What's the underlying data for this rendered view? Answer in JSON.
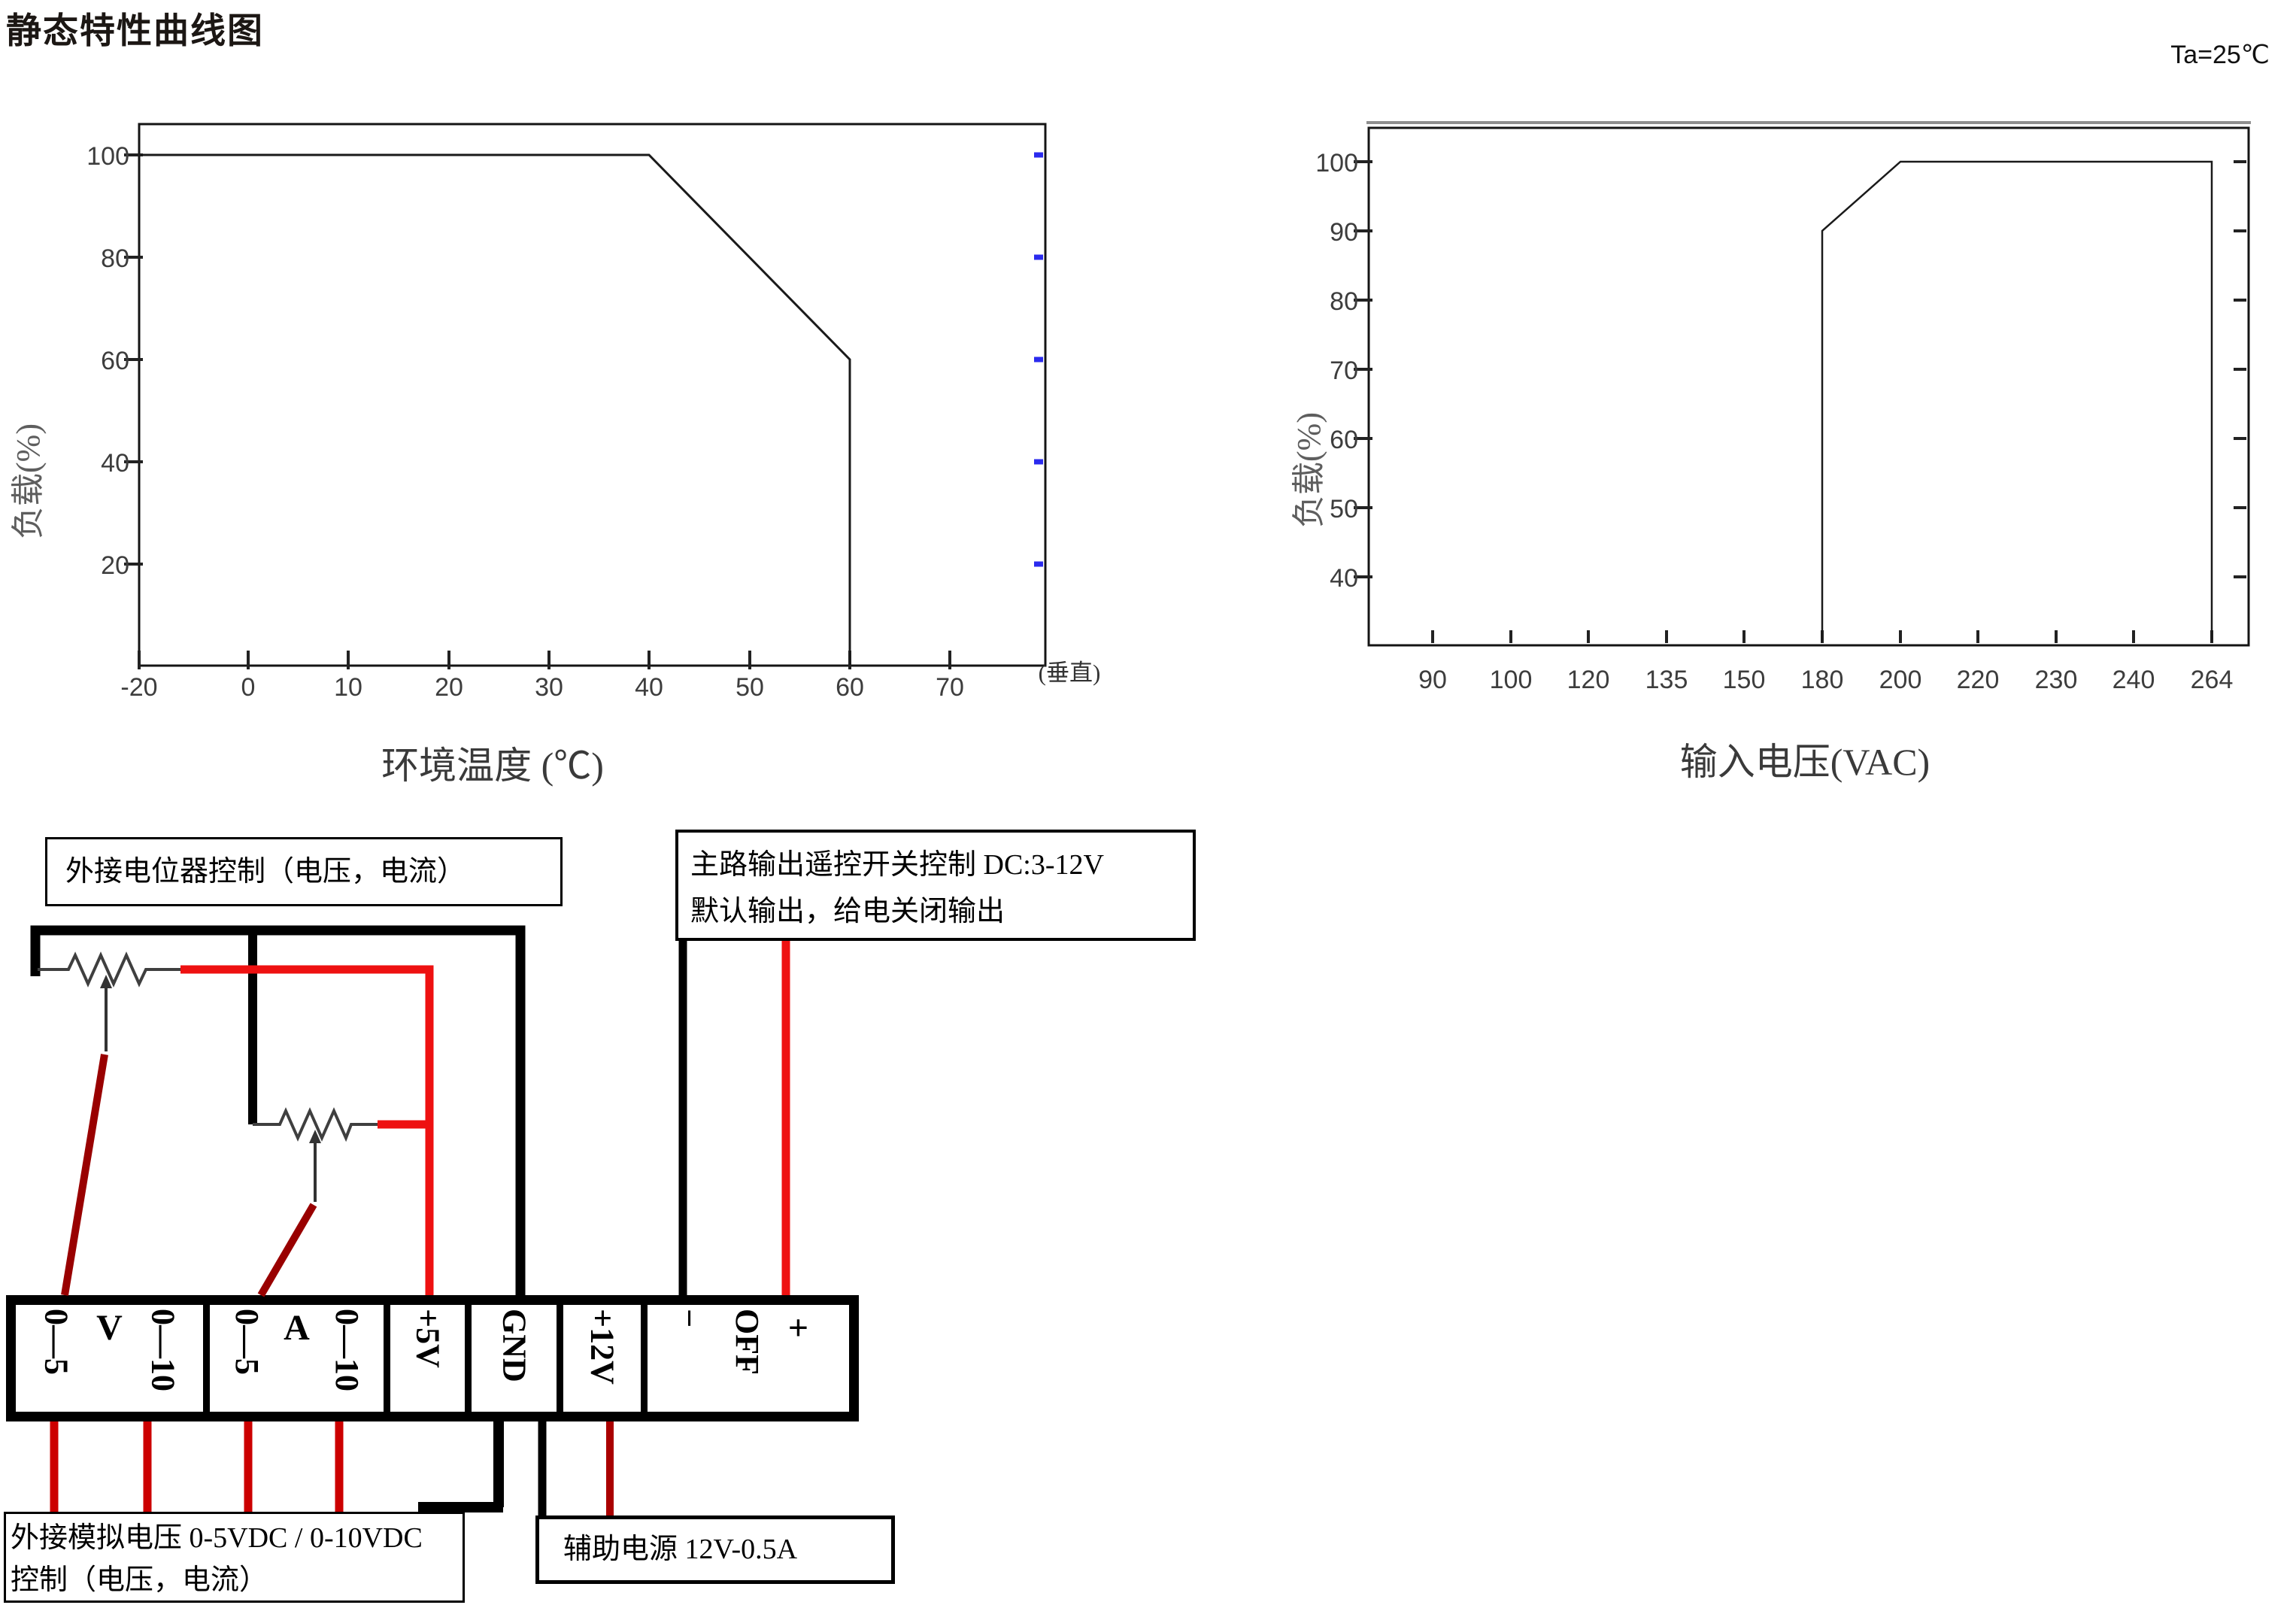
{
  "page": {
    "title": "静态特性曲线图"
  },
  "chart_data": [
    {
      "type": "line",
      "title": "",
      "xlabel": "环境温度 (℃)",
      "ylabel": "负载(%)",
      "x_axis_suffix": "(垂直)",
      "xticks": [
        -20,
        0,
        10,
        20,
        30,
        40,
        50,
        60,
        70
      ],
      "yticks": [
        100,
        80,
        60,
        40,
        20
      ],
      "ylim": [
        0,
        113
      ],
      "xlim": [
        -20,
        78
      ],
      "grid": false,
      "legend": "none",
      "series": [
        {
          "name": "负载-温度降额曲线",
          "points": [
            [
              -20,
              100
            ],
            [
              40,
              100
            ],
            [
              60,
              60
            ],
            [
              60,
              0.3
            ]
          ]
        }
      ],
      "right_edge_tick_values": [
        100,
        80,
        60,
        40,
        20
      ]
    },
    {
      "type": "line",
      "title": "",
      "annotation": "Ta=25℃",
      "xlabel": "输入电压(VAC)",
      "ylabel": "负载(%)",
      "xticks": [
        90,
        100,
        120,
        135,
        150,
        180,
        200,
        220,
        230,
        240,
        264
      ],
      "yticks": [
        100,
        90,
        80,
        70,
        60,
        50,
        40
      ],
      "ylim": [
        30,
        108
      ],
      "grid": false,
      "legend": "none",
      "series": [
        {
          "name": "负载-输入电压曲线",
          "points": [
            [
              180,
              30.6
            ],
            [
              180,
              90
            ],
            [
              200,
              100
            ],
            [
              264,
              100
            ],
            [
              264,
              30.6
            ]
          ]
        }
      ]
    }
  ],
  "wiring": {
    "callouts": {
      "pot_control": "外接电位器控制（电压，电流）",
      "remote_line1": "主路输出遥控开关控制 DC:3-12V",
      "remote_line2": "默认输出，给电关闭输出",
      "analog_line1": "外接模拟电压 0-5VDC / 0-10VDC",
      "analog_line2": "控制（电压，电流）",
      "aux": "辅助电源 12V-0.5A"
    },
    "terminal_cells": [
      {
        "name": "voltage-program",
        "parts": [
          {
            "text": "0—5",
            "vertical": true
          },
          {
            "text": "V",
            "vertical": false
          },
          {
            "text": "0—10",
            "vertical": true
          }
        ]
      },
      {
        "name": "current-program",
        "parts": [
          {
            "text": "0—5",
            "vertical": true
          },
          {
            "text": "A",
            "vertical": false
          },
          {
            "text": "0—10",
            "vertical": true
          }
        ]
      },
      {
        "name": "plus5v",
        "parts": [
          {
            "text": "+5V",
            "vertical": true
          }
        ]
      },
      {
        "name": "gnd",
        "parts": [
          {
            "text": "GND",
            "vertical": true
          }
        ]
      },
      {
        "name": "plus12v",
        "parts": [
          {
            "text": "+12V",
            "vertical": true
          }
        ]
      },
      {
        "name": "remote-onoff",
        "parts": [
          {
            "text": "−",
            "vertical": true
          },
          {
            "text": "OFF",
            "vertical": true
          },
          {
            "text": "+",
            "vertical": false
          }
        ]
      }
    ]
  },
  "colors": {
    "wire_red": "#ee1111",
    "wire_crimson": "#cc0000",
    "wire_dark_red": "#990000",
    "wire_black": "#000000",
    "blue_right_ticks": "#2a2aee",
    "curve": "#1a1a1a"
  }
}
